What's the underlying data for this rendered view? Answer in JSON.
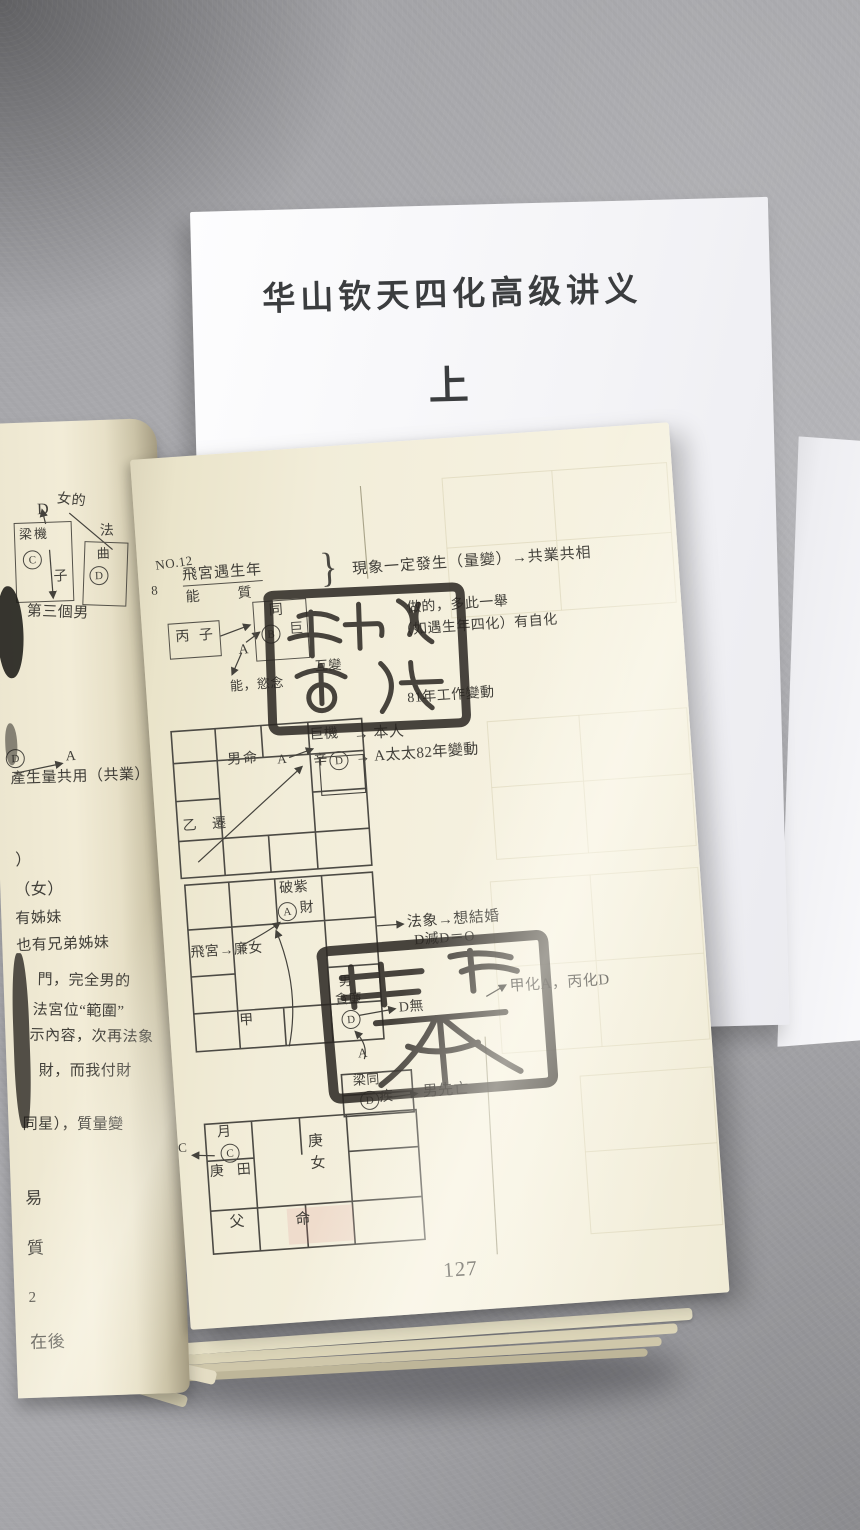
{
  "colors": {
    "fabric": "#a9a9ad",
    "cover_white": "#f6f6f8",
    "page_cream": "#f1ecd6",
    "ink": "#413f39",
    "seal_ink": "#2a2621"
  },
  "cover": {
    "title": "华山钦天四化高级讲义",
    "volume": "上"
  },
  "book": {
    "left_page": {
      "diagram": {
        "d_label": "D",
        "female": "女的",
        "fa": "法",
        "box1_stars": "梁機",
        "box1_circle": "C",
        "box1_branch": "子",
        "box2_star": "曲",
        "box2_circle": "D",
        "caption": "第三個男",
        "mid_circle": "D",
        "mid_a": "A",
        "mid_line": "產生量共用（共業）"
      },
      "lines": [
        "）",
        "（女）",
        "有姊妹",
        "也有兄弟姊妹",
        "門，完全男的",
        "法宮位“範圍”",
        "示內容，次再法象",
        "財，而我付財",
        "同星），質量變",
        "易",
        "質",
        "2",
        "在後"
      ]
    },
    "right_page": {
      "header": {
        "no": "NO.12",
        "item": "8",
        "topic": "飛宮遇生年",
        "topic_sub_left": "能",
        "topic_sub_right": "質",
        "brace": "}",
        "statement": "現象一定發生（量變）→共業共相"
      },
      "diagram1": {
        "box1": "丙 子",
        "box2_top": "同",
        "box2_circle": "B",
        "box2_side": "巨",
        "a": "A",
        "mutual": "互變",
        "desire": "能，慾念",
        "note1": "做的，多此一舉",
        "note2": "（如遇生年四化）有自化",
        "note3": "81年工作變動"
      },
      "grid1": {
        "ming": "男命",
        "a": "A",
        "top_right_star": "巨機",
        "stem": "辛",
        "circle": "D",
        "bottom_left": "乙 遷",
        "ann_person": "→ 本人",
        "ann_wife": "→ A太太82年變動"
      },
      "grid2": {
        "top_star": "破紫",
        "circle_a": "A",
        "cai": "財",
        "fly": "飛宮→廉女",
        "stem": "甲",
        "nan": "男",
        "stars": "貪廉",
        "circle_d": "D",
        "ann_dwu": "D無",
        "a_small": "A",
        "ann_fa": "法象→想結婚",
        "ann_sub": "D減D＝O",
        "ann_hua": "甲化A，丙化D"
      },
      "grid3": {
        "stars": "梁同",
        "circle_d": "D",
        "ji": "疾",
        "ann_death": "男先亡",
        "yue": "月",
        "circle_c": "C",
        "stem": "庚",
        "tian": "田",
        "c_out": "C",
        "center_top": "庚",
        "center_bottom": "女",
        "fu": "父",
        "ming": "命"
      },
      "page_number": "127"
    }
  }
}
